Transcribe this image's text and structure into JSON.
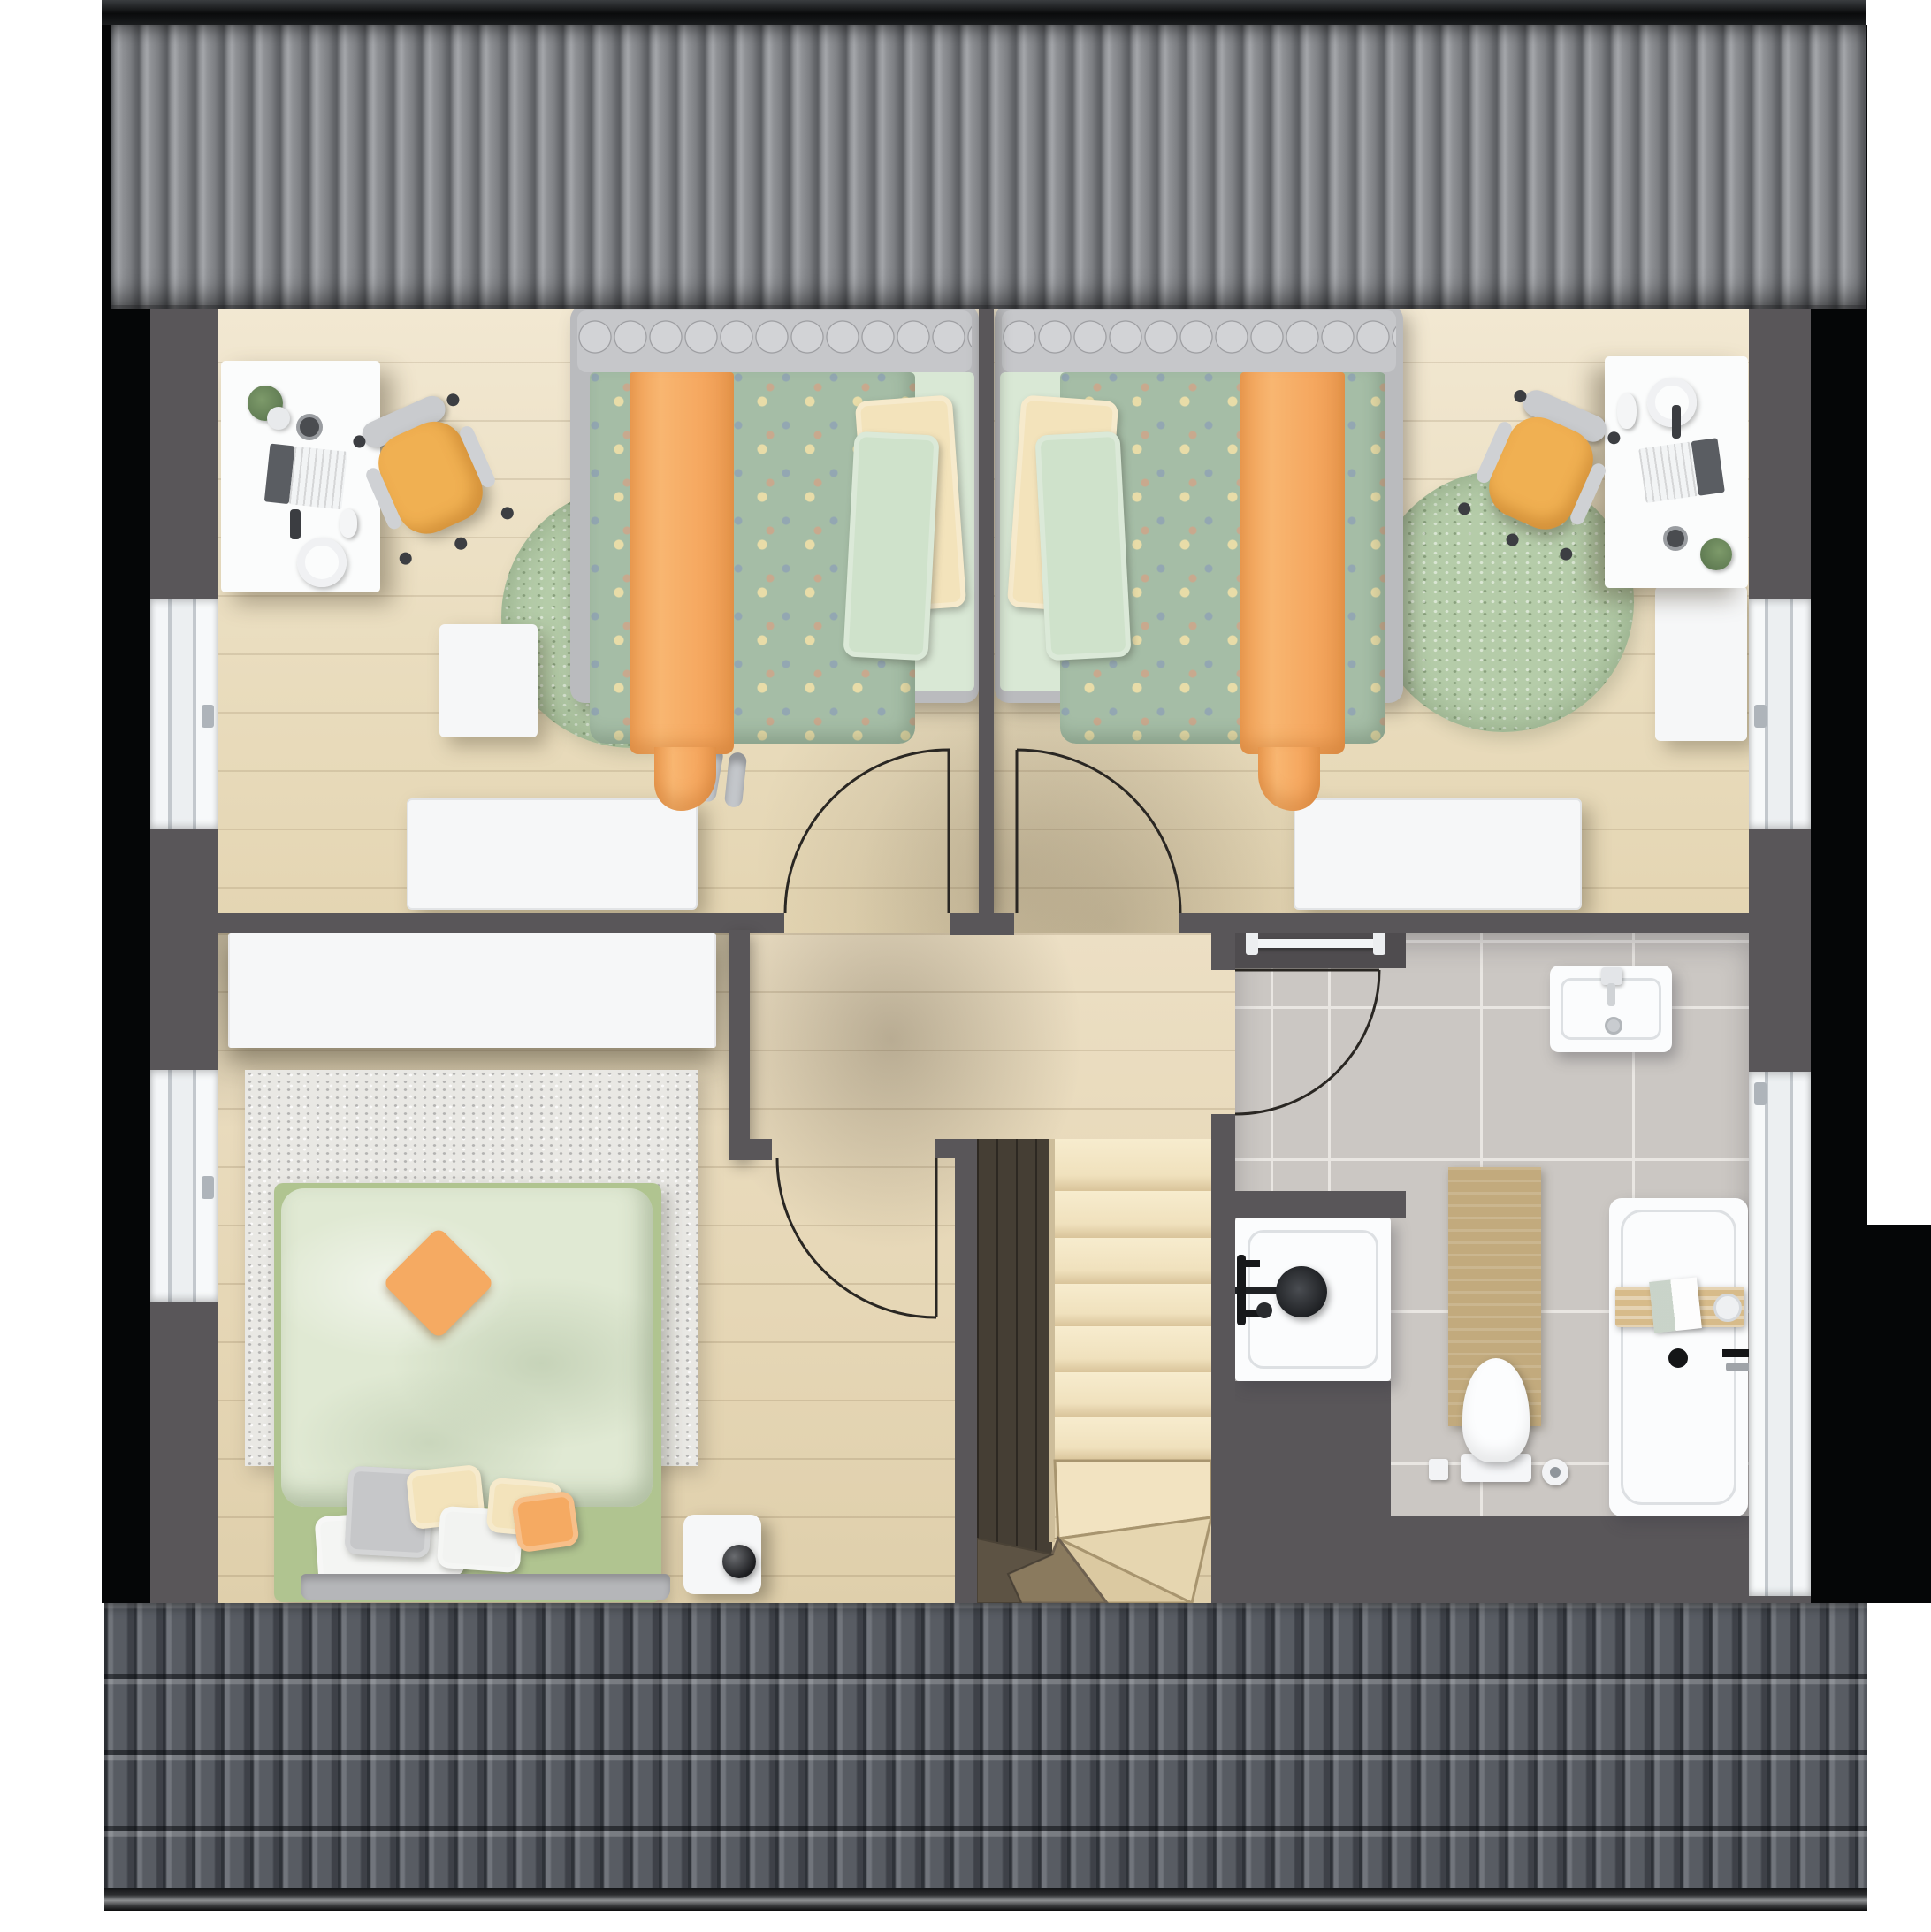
{
  "meta": {
    "title": "Attic storey floor plan – top-down 3D render",
    "view": "orthographic top view",
    "visible_text": "none"
  },
  "colors": {
    "wall": "#595659",
    "black_bar": "#0a0b0c",
    "roof_bottom_base": "#585c63",
    "floor_tile": "#cbc7c3",
    "rug_green": "#b5cca9",
    "rug_light": "#e9e8e4",
    "bed_frame": "#babbbe",
    "duvet_polka": "#a5bda6",
    "accent_orange": "#f5aa62",
    "sheet_green": "#d9e8d5",
    "pillow_cream": "#f3e3bb",
    "master_sheet": "#b0c490",
    "master_duvet": "#e0e9d3",
    "stairs_wood": "#f3e5c3",
    "stairs_void": "#453e34",
    "fixture_white": "#fafbfc",
    "mat_tan": "#c2aa7d",
    "caddy_wood": "#d7bb8a",
    "chair_yellow": "#f0b052"
  },
  "structure": {
    "roofs": [
      {
        "id": "roof-top",
        "style": "corrugated standing-seam, vertical ribs"
      },
      {
        "id": "roof-bottom",
        "style": "interlocking roof tiles with eaves gutter"
      }
    ],
    "windows": [
      {
        "id": "window-left-bedroom1",
        "wall": "left"
      },
      {
        "id": "window-left-master",
        "wall": "left"
      },
      {
        "id": "window-right-bedroom2",
        "wall": "right"
      },
      {
        "id": "window-right-bathroom",
        "wall": "right"
      }
    ],
    "doors": [
      {
        "id": "door-bedroom1",
        "swing": "into left child bedroom"
      },
      {
        "id": "door-bedroom2",
        "swing": "into right child bedroom"
      },
      {
        "id": "door-bathroom",
        "swing": "into bathroom"
      },
      {
        "id": "door-master",
        "swing": "into master bedroom"
      }
    ]
  },
  "rooms": [
    {
      "id": "bedroom-left",
      "label": "child bedroom 1",
      "furniture": [
        "desk with laptop, plant, headphones, mouse",
        "yellow swivel chair",
        "single bed with polka-dot duvet and orange throw",
        "round green rug",
        "slippers",
        "radiator",
        "storage box"
      ]
    },
    {
      "id": "bedroom-right",
      "label": "child bedroom 2",
      "furniture": [
        "desk with laptop, plant, headphones",
        "yellow swivel chair",
        "single bed with polka-dot duvet and orange throw",
        "round green rug",
        "radiator",
        "side cabinet"
      ]
    },
    {
      "id": "master-bedroom",
      "label": "master bedroom",
      "furniture": [
        "wardrobe",
        "double bed with green duvet, orange cushion and pillow group",
        "light rug",
        "nightstand with sphere lamp"
      ]
    },
    {
      "id": "hallway",
      "label": "landing / hallway",
      "furniture": [
        "winder staircase",
        "stair railing"
      ]
    },
    {
      "id": "bathroom",
      "label": "bathroom",
      "furniture": [
        "washbasin",
        "shower with black fixture",
        "toilet with paper holder and brush",
        "bathtub with wooden caddy",
        "tan bath mat",
        "towel rail"
      ]
    }
  ]
}
